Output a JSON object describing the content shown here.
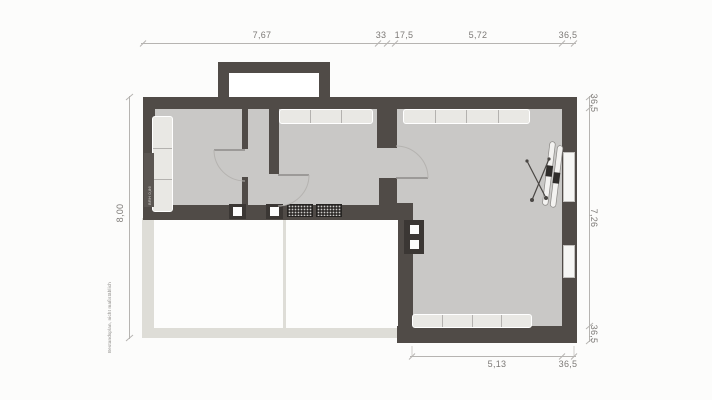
{
  "dims": {
    "top": [
      "7,67",
      "33",
      "17,5",
      "5,72",
      "36,5"
    ],
    "left": "8,00",
    "right": [
      "36,5",
      "7,26",
      "36,5"
    ],
    "bottom": [
      "5,13",
      "36,5"
    ]
  },
  "notes": {
    "margin": "Bestandsplan, nicht maßstäblich",
    "window_label": "BRH 0,86"
  },
  "colors": {
    "wall": "#504b47",
    "floor": "#c9c8c6",
    "light_wall": "#deddd7",
    "furniture": "#e9e8e4",
    "dim_line": "#b6b4b1",
    "dim_text": "#7d7a77",
    "background": "#fcfcfb"
  }
}
